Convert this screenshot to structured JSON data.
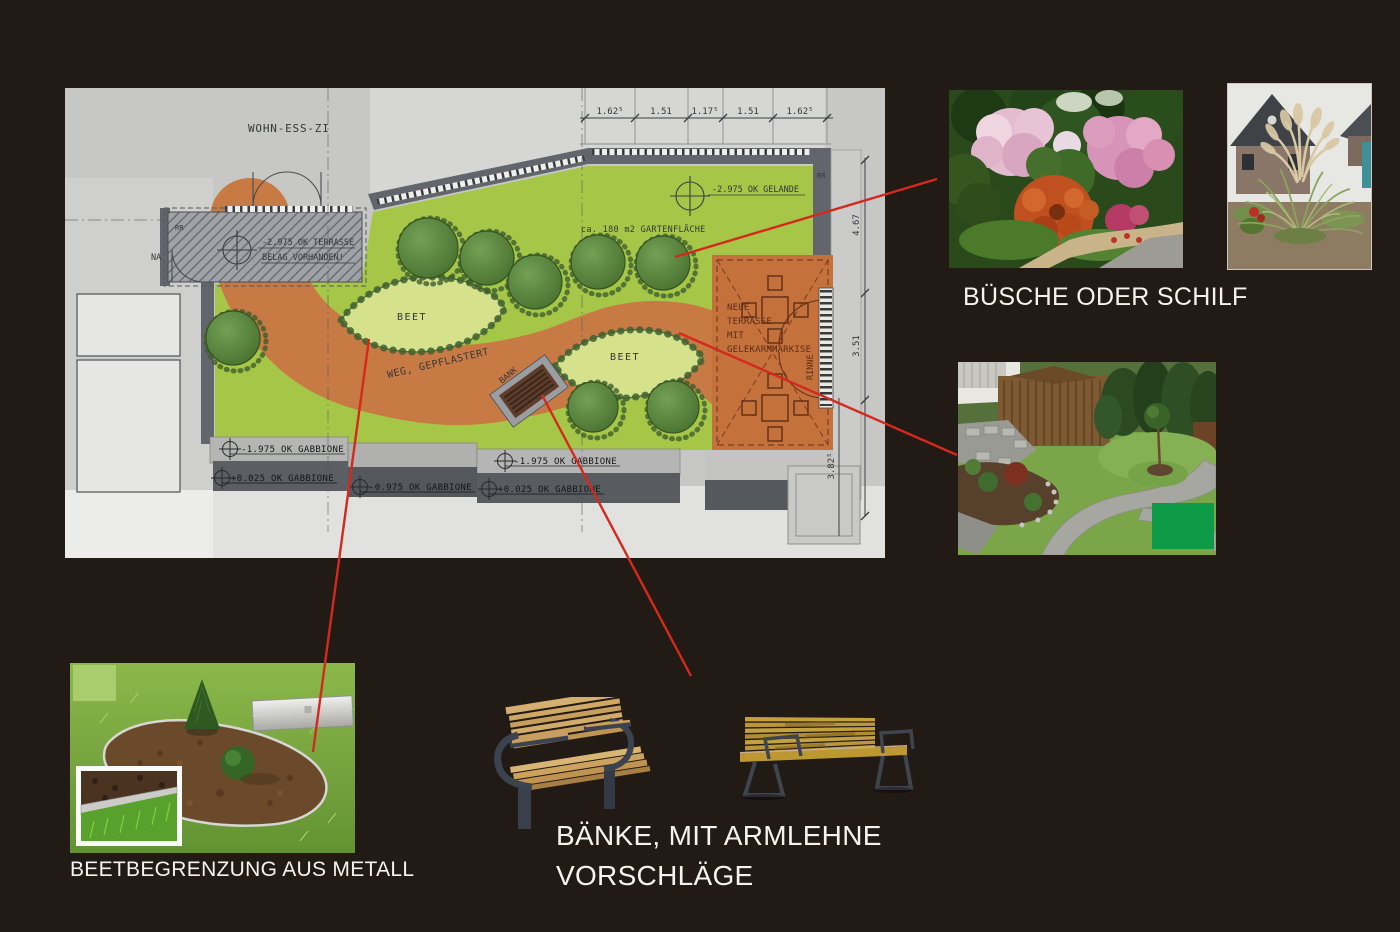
{
  "plan": {
    "room_label": "WOHN-ESS-ZI",
    "terrace_existing_1": "-2.975 OK TERRASSE",
    "terrace_existing_2": "BELAG VORHANDEN!",
    "na_label": "NA",
    "rr_label_1": "RR",
    "rr_label_2": "RR",
    "ground_level": "-2.975 OK GELANDE",
    "garden_area": "ca. 180 m2 GARTENFLÄCHE",
    "path_label": "WEG, GEPFLASTERT",
    "bed_label_1": "BEET",
    "bed_label_2": "BEET",
    "bench_label": "BANK",
    "new_terrace_lines": [
      "NEUE",
      "TERRASSE",
      "MIT",
      "GELEKARMMARKISE"
    ],
    "gutter_label": "RINNE",
    "gabion_labels": [
      "-1.975 OK GABBIONE",
      "+0.025 OK GABBIONE",
      "-0.975 OK GABBIONE",
      "-1.975 OK GABBIONE",
      "+0.025 OK GABBIONE"
    ],
    "dims_top": [
      "1.62⁵",
      "1.51",
      "1.17⁵",
      "1.51",
      "1.62⁵"
    ],
    "dims_right": [
      "4.67",
      "3.51",
      "3.82⁵"
    ]
  },
  "annotations": {
    "bushes_title": "BÜSCHE ODER SCHILF",
    "edging_title": "BEETBEGRENZUNG AUS METALL",
    "benches_title_1": "BÄNKE, MIT ARMLEHNE",
    "benches_title_2": "VORSCHLÄGE"
  },
  "colors": {
    "background": "#211a15",
    "connector": "#d42a1e",
    "lawn": "#a6c648",
    "path_orange": "#c87a44",
    "overlay_green": "#0d9b47"
  }
}
